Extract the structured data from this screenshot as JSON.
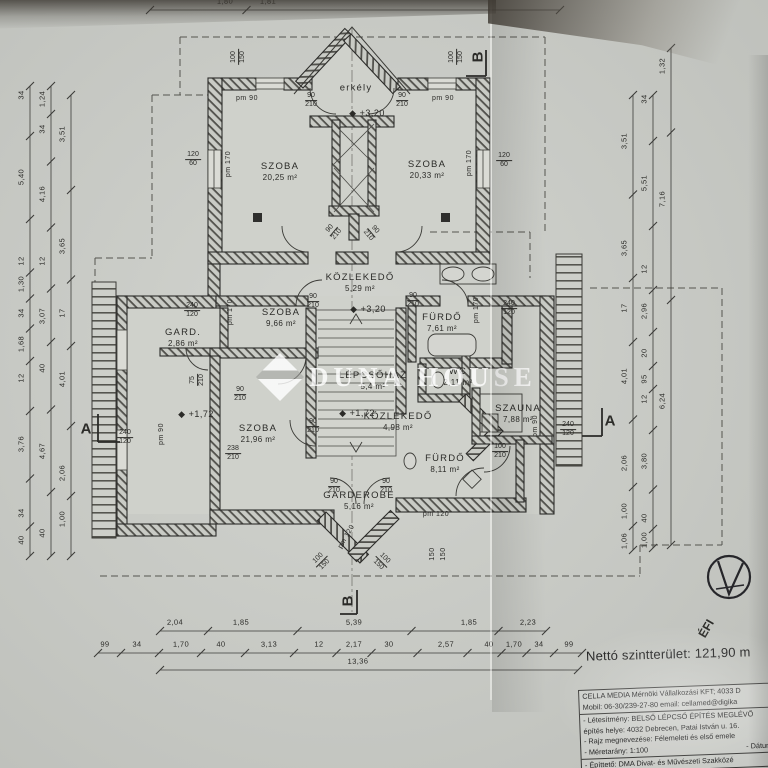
{
  "watermark": {
    "brand": "DUNA HOUSE"
  },
  "summary": {
    "net_area": "Nettó szintterület: 121,90 m"
  },
  "title_block": {
    "company": "CELLA MEDIA  Mérnöki Vállalkozási KFT; 4033 D",
    "contact": "Mobil: 06-30/239-27-80    email: cellamed@digika",
    "project": "- Létesítmény: BELSŐ LÉPCSŐ ÉPÍTÉS MEGLÉVŐ",
    "address": "építés helye: 4032 Debrecen, Patai István u. 16.",
    "drawing": "- Rajz megnevezése: Félemeleti és első emele",
    "scale": "- Méretarány: 1:100",
    "date": "- Dátum: 2",
    "client": "- Építtető: DMA Divat- és Művészeti Szakközé"
  },
  "plan": {
    "level_icon": "◆",
    "rooms": [
      {
        "n": "erkély",
        "x": 356,
        "y": 89
      },
      {
        "n": "SZOBA",
        "a": "20,25 m²",
        "x": 280,
        "y": 172
      },
      {
        "n": "SZOBA",
        "a": "20,33 m²",
        "x": 427,
        "y": 170
      },
      {
        "n": "KÖZLEKEDŐ",
        "a": "5,29 m²",
        "x": 360,
        "y": 283
      },
      {
        "n": "SZOBA",
        "a": "9,66 m²",
        "x": 281,
        "y": 318
      },
      {
        "n": "GARD.",
        "a": "2,86 m²",
        "x": 183,
        "y": 338
      },
      {
        "n": "FÜRDŐ",
        "a": "7,61 m²",
        "x": 442,
        "y": 323
      },
      {
        "n": "LÉPCSŐHÁZ",
        "a": "5,4 m²",
        "x": 373,
        "y": 381
      },
      {
        "n": "WC",
        "a": "2,11 m²",
        "x": 458,
        "y": 377
      },
      {
        "n": "SZOBA",
        "a": "21,96 m²",
        "x": 258,
        "y": 434
      },
      {
        "n": "KÖZLEKEDŐ",
        "a": "4,98 m²",
        "x": 398,
        "y": 422
      },
      {
        "n": "SZAUNA",
        "a": "7,88 m²",
        "x": 518,
        "y": 414
      },
      {
        "n": "FÜRDŐ",
        "a": "8,11 m²",
        "x": 445,
        "y": 464
      },
      {
        "n": "GARDEROBE",
        "a": "5,16 m²",
        "x": 359,
        "y": 501
      }
    ],
    "levels": [
      {
        "t": "+3,20",
        "x": 367,
        "y": 113
      },
      {
        "t": "+3,20",
        "x": 368,
        "y": 309
      },
      {
        "t": "+1,72",
        "x": 196,
        "y": 414
      },
      {
        "t": "+1,72",
        "x": 357,
        "y": 413
      }
    ],
    "tags": [
      {
        "a": "100",
        "b": "150",
        "x": 239,
        "y": 57,
        "r": -90
      },
      {
        "a": "100",
        "b": "150",
        "x": 457,
        "y": 57,
        "r": -90
      },
      {
        "t": "pm  90",
        "x": 247,
        "y": 99
      },
      {
        "t": "pm  90",
        "x": 443,
        "y": 99
      },
      {
        "a": "90",
        "b": "210",
        "x": 311,
        "y": 101
      },
      {
        "a": "90",
        "b": "210",
        "x": 402,
        "y": 101
      },
      {
        "a": "120",
        "b": "60",
        "x": 193,
        "y": 160
      },
      {
        "t": "pm 170",
        "x": 229,
        "y": 164,
        "r": -90
      },
      {
        "a": "120",
        "b": "60",
        "x": 504,
        "y": 161
      },
      {
        "t": "pm 170",
        "x": 470,
        "y": 163,
        "r": -90
      },
      {
        "a": "90",
        "b": "210",
        "x": 334,
        "y": 232,
        "r": -50
      },
      {
        "a": "90",
        "b": "210",
        "x": 371,
        "y": 233,
        "r": 50
      },
      {
        "a": "90",
        "b": "210",
        "x": 313,
        "y": 302
      },
      {
        "a": "90",
        "b": "210",
        "x": 413,
        "y": 301
      },
      {
        "a": "240",
        "b": "120",
        "x": 192,
        "y": 311
      },
      {
        "t": "pm 170",
        "x": 231,
        "y": 312,
        "r": -90
      },
      {
        "t": "pm 170",
        "x": 477,
        "y": 310,
        "r": -90
      },
      {
        "a": "240",
        "b": "120",
        "x": 509,
        "y": 309
      },
      {
        "a": "75",
        "b": "210",
        "x": 198,
        "y": 380,
        "r": -90
      },
      {
        "a": "90",
        "b": "210",
        "x": 240,
        "y": 395
      },
      {
        "a": "90",
        "b": "210",
        "x": 313,
        "y": 427
      },
      {
        "a": "238",
        "b": "210",
        "x": 233,
        "y": 454
      },
      {
        "a": "240",
        "b": "120",
        "x": 125,
        "y": 438
      },
      {
        "t": "pm  90",
        "x": 162,
        "y": 434,
        "r": -90
      },
      {
        "t": "pm  90",
        "x": 536,
        "y": 426,
        "r": -90
      },
      {
        "a": "240",
        "b": "120",
        "x": 568,
        "y": 430
      },
      {
        "a": "100",
        "b": "210",
        "x": 500,
        "y": 452
      },
      {
        "t": "pm 120",
        "x": 436,
        "y": 515
      },
      {
        "a": "90",
        "b": "210",
        "x": 334,
        "y": 487
      },
      {
        "a": "90",
        "b": "210",
        "x": 386,
        "y": 487
      },
      {
        "t": "pm 120",
        "x": 347,
        "y": 537,
        "r": -60
      },
      {
        "t": "150",
        "x": 433,
        "y": 554,
        "r": -90
      },
      {
        "t": "150",
        "x": 444,
        "y": 554,
        "r": -90
      },
      {
        "a": "100",
        "b": "150",
        "x": 322,
        "y": 562,
        "r": -45
      },
      {
        "a": "100",
        "b": "150",
        "x": 381,
        "y": 562,
        "r": 45
      }
    ],
    "free": [
      {
        "t": "B",
        "x": 478,
        "y": 57,
        "r": -90,
        "s": 15,
        "n": "section-marker-b-top"
      },
      {
        "t": "B",
        "x": 348,
        "y": 601,
        "r": -90,
        "s": 15,
        "n": "section-marker-b-bottom"
      },
      {
        "t": "A",
        "x": 86,
        "y": 429,
        "s": 15,
        "n": "section-marker-a-left"
      },
      {
        "t": "A",
        "x": 610,
        "y": 421,
        "s": 15,
        "n": "section-marker-a-right"
      },
      {
        "t": "ÉFI",
        "x": 707,
        "y": 629,
        "r": -60,
        "s": 12,
        "n": "north-label"
      }
    ],
    "dims": {
      "chains": [
        {
          "axis": "v",
          "pos": 30,
          "from": 86,
          "to": 556,
          "labels": [
            {
              "t": "34",
              "p": 95
            },
            {
              "t": "5,40",
              "p": 177
            },
            {
              "t": "12",
              "p": 261
            },
            {
              "t": "1,30",
              "p": 284
            },
            {
              "t": "34",
              "p": 313
            },
            {
              "t": "1,68",
              "p": 344
            },
            {
              "t": "12",
              "p": 378
            },
            {
              "t": "3,76",
              "p": 444
            },
            {
              "t": "34",
              "p": 513
            },
            {
              "t": "40",
              "p": 540
            }
          ]
        },
        {
          "axis": "v",
          "pos": 51,
          "from": 86,
          "to": 556,
          "labels": [
            {
              "t": "1,24",
              "p": 99
            },
            {
              "t": "34",
              "p": 129
            },
            {
              "t": "4,16",
              "p": 194
            },
            {
              "t": "12",
              "p": 261
            },
            {
              "t": "3,07",
              "p": 316
            },
            {
              "t": "40",
              "p": 368
            },
            {
              "t": "4,67",
              "p": 451
            },
            {
              "t": "40",
              "p": 533
            }
          ]
        },
        {
          "axis": "v",
          "pos": 71,
          "from": 95,
          "to": 556,
          "labels": [
            {
              "t": "3,51",
              "p": 134
            },
            {
              "t": "3,65",
              "p": 246
            },
            {
              "t": "17",
              "p": 313
            },
            {
              "t": "4,01",
              "p": 379
            },
            {
              "t": "2,06",
              "p": 473
            },
            {
              "t": "1,00",
              "p": 519
            }
          ]
        },
        {
          "axis": "v",
          "pos": 633,
          "from": 95,
          "to": 550,
          "labels": [
            {
              "t": "3,51",
              "p": 141
            },
            {
              "t": "3,65",
              "p": 248
            },
            {
              "t": "17",
              "p": 308
            },
            {
              "t": "4,01",
              "p": 376
            },
            {
              "t": "2,06",
              "p": 463
            },
            {
              "t": "1,00",
              "p": 511
            },
            {
              "t": "1,06",
              "p": 541
            }
          ]
        },
        {
          "axis": "v",
          "pos": 653,
          "from": 95,
          "to": 548,
          "labels": [
            {
              "t": "34",
              "p": 99
            },
            {
              "t": "5,51",
              "p": 183
            },
            {
              "t": "12",
              "p": 269
            },
            {
              "t": "2,96",
              "p": 311
            },
            {
              "t": "20",
              "p": 353
            },
            {
              "t": "95",
              "p": 379
            },
            {
              "t": "12",
              "p": 399
            },
            {
              "t": "3,80",
              "p": 461
            },
            {
              "t": "40",
              "p": 518
            },
            {
              "t": "1,00",
              "p": 540
            }
          ]
        },
        {
          "axis": "v",
          "pos": 671,
          "from": 48,
          "to": 545,
          "labels": [
            {
              "t": "1,32",
              "p": 66
            },
            {
              "t": "7,16",
              "p": 199
            },
            {
              "t": "6,24",
              "p": 401
            }
          ]
        },
        {
          "axis": "h",
          "pos": 631,
          "from": 160,
          "to": 546,
          "labels": [
            {
              "t": "2,04",
              "p": 175
            },
            {
              "t": "1,85",
              "p": 241
            },
            {
              "t": "5,39",
              "p": 354
            },
            {
              "t": "1,85",
              "p": 469
            },
            {
              "t": "2,23",
              "p": 528
            }
          ]
        },
        {
          "axis": "h",
          "pos": 653,
          "from": 98,
          "to": 582,
          "labels": [
            {
              "t": "99",
              "p": 105
            },
            {
              "t": "34",
              "p": 137
            },
            {
              "t": "1,70",
              "p": 181
            },
            {
              "t": "40",
              "p": 221
            },
            {
              "t": "3,13",
              "p": 269
            },
            {
              "t": "12",
              "p": 319
            },
            {
              "t": "2,17",
              "p": 354
            },
            {
              "t": "30",
              "p": 389
            },
            {
              "t": "2,57",
              "p": 446
            },
            {
              "t": "40",
              "p": 489
            },
            {
              "t": "1,70",
              "p": 514
            },
            {
              "t": "34",
              "p": 539
            },
            {
              "t": "99",
              "p": 569
            }
          ]
        },
        {
          "axis": "h",
          "pos": 670,
          "from": 160,
          "to": 578,
          "labels": [
            {
              "t": "13,36",
              "p": 358
            }
          ]
        },
        {
          "axis": "h",
          "pos": 10,
          "from": 150,
          "to": 560,
          "labels": [
            {
              "t": "1,80",
              "p": 225
            },
            {
              "t": "1,81",
              "p": 268
            }
          ]
        }
      ]
    }
  }
}
